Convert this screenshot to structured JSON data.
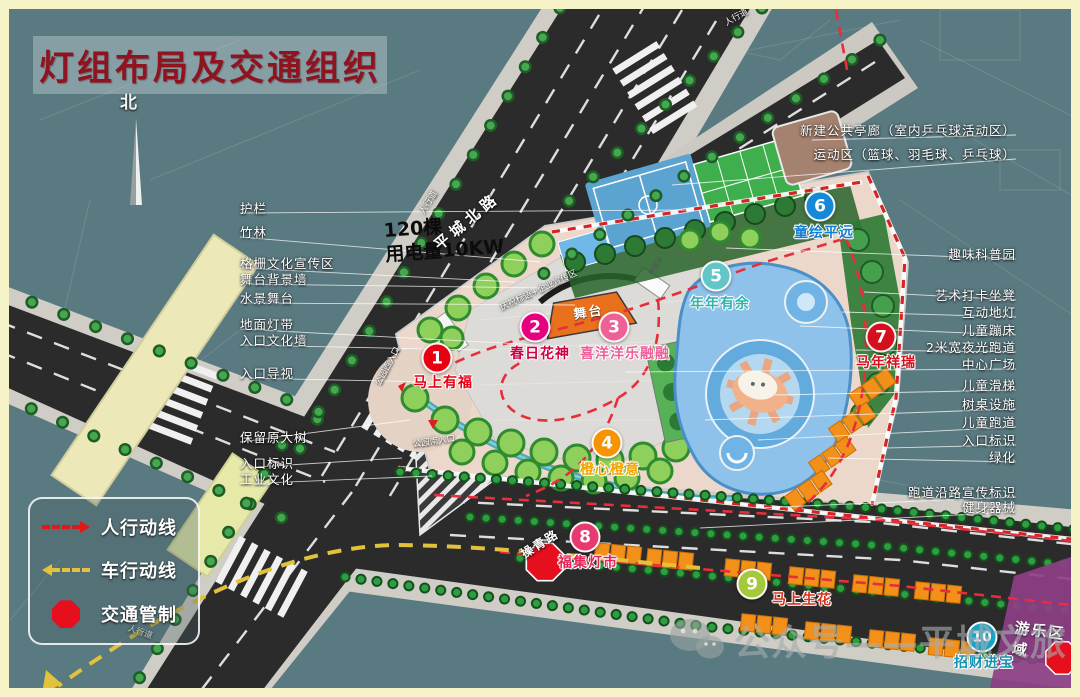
{
  "title": "灯组布局及交通组织",
  "compass": {
    "label": "北"
  },
  "note": {
    "line1": "120棵",
    "line2": "用电量10KW"
  },
  "roads": {
    "north_road": "平城北路",
    "south_road": "操青路",
    "sidewalk": "人行道"
  },
  "legend": {
    "pedestrian": "人行动线",
    "vehicle": "车行动线",
    "control": "交通管制"
  },
  "markers": [
    {
      "num": "1",
      "label": "马上有福"
    },
    {
      "num": "2",
      "label": "春日花神"
    },
    {
      "num": "3",
      "label": "喜洋洋乐融融"
    },
    {
      "num": "4",
      "label": "橙心橙意"
    },
    {
      "num": "5",
      "label": "年年有余"
    },
    {
      "num": "6",
      "label": "童绘平远"
    },
    {
      "num": "7",
      "label": "马年祥瑞"
    },
    {
      "num": "8",
      "label": "福集灯市"
    },
    {
      "num": "9",
      "label": "马上生花"
    },
    {
      "num": "10",
      "label": "招财进宝"
    }
  ],
  "left_labels": [
    "护栏",
    "竹林",
    "格栅文化宣传区",
    "舞台背景墙",
    "水景舞台",
    "地面灯带",
    "入口文化墙",
    "入口导视",
    "保留原大树",
    "入口标识",
    "工业文化"
  ],
  "right_labels": [
    "新建公共亭廊（室内乒乓球活动区）",
    "运动区（篮球、羽毛球、乒乓球）",
    "趣味科普园",
    "艺术打卡坐凳",
    "互动地灯",
    "儿童蹦床",
    "2米宽夜光跑道",
    "中心广场",
    "儿童滑梯",
    "树桌设施",
    "儿童跑道",
    "入口标识",
    "绿化",
    "跑道沿路宣传标识",
    "健身器械"
  ],
  "site": {
    "stage": "舞台",
    "pavilion": "休憩亭",
    "banner_zone": "庆祝标语+企业宣传区",
    "west_entrance": "公园西入口",
    "south_entrance": "公园南入口",
    "play_zone": "游乐区域"
  },
  "watermark": {
    "text": "公众号——平城文旅"
  },
  "colors": {
    "background": "#5a7a81",
    "frame": "#f6f3c9",
    "road": "#2b2b2b",
    "park_paving": "#ecd8ca",
    "title_red": "#8f1420",
    "route_red": "#e62e3c",
    "route_yellow": "#e2c23c",
    "stall_orange": "#f39019",
    "play_purple": "#8d3f86",
    "marker_colors": [
      "#e60012",
      "#e5007e",
      "#ee6197",
      "#f59300",
      "#63c6c6",
      "#1588d8",
      "#d60f1c",
      "#e73a6e",
      "#a6c93b",
      "#17a2c8"
    ]
  }
}
